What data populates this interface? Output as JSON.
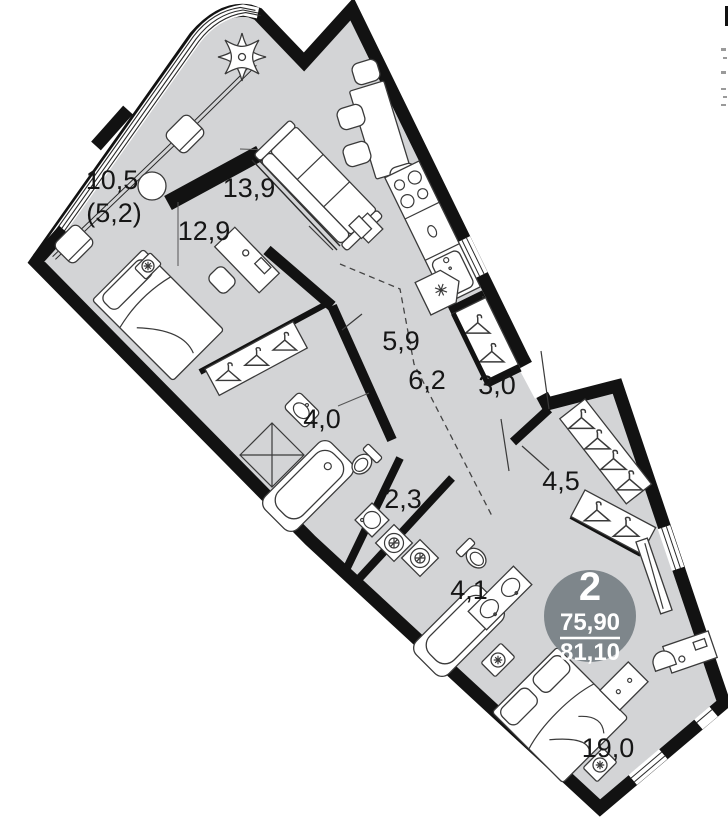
{
  "plan": {
    "badge": {
      "room_count": "2",
      "area_living": "75,90",
      "area_total": "81,10"
    },
    "rooms": [
      {
        "name": "room-10-5",
        "label": "10,5",
        "sublabel": "(5,2)"
      },
      {
        "name": "living-13-9",
        "label": "13,9"
      },
      {
        "name": "room-12-9",
        "label": "12,9"
      },
      {
        "name": "hall-5-9",
        "label": "5,9"
      },
      {
        "name": "hall-6-2",
        "label": "6,2"
      },
      {
        "name": "wardrobe-3-0",
        "label": "3,0"
      },
      {
        "name": "bathroom-4-0",
        "label": "4,0"
      },
      {
        "name": "corridor-2-3",
        "label": "2,3"
      },
      {
        "name": "dressing-4-5",
        "label": "4,5"
      },
      {
        "name": "bathroom-4-1",
        "label": "4,1"
      },
      {
        "name": "bedroom-19-0",
        "label": "19,0"
      }
    ],
    "colors": {
      "floor": "#d3d4d6",
      "wall": "#121212",
      "badge": "#7e868b"
    }
  }
}
